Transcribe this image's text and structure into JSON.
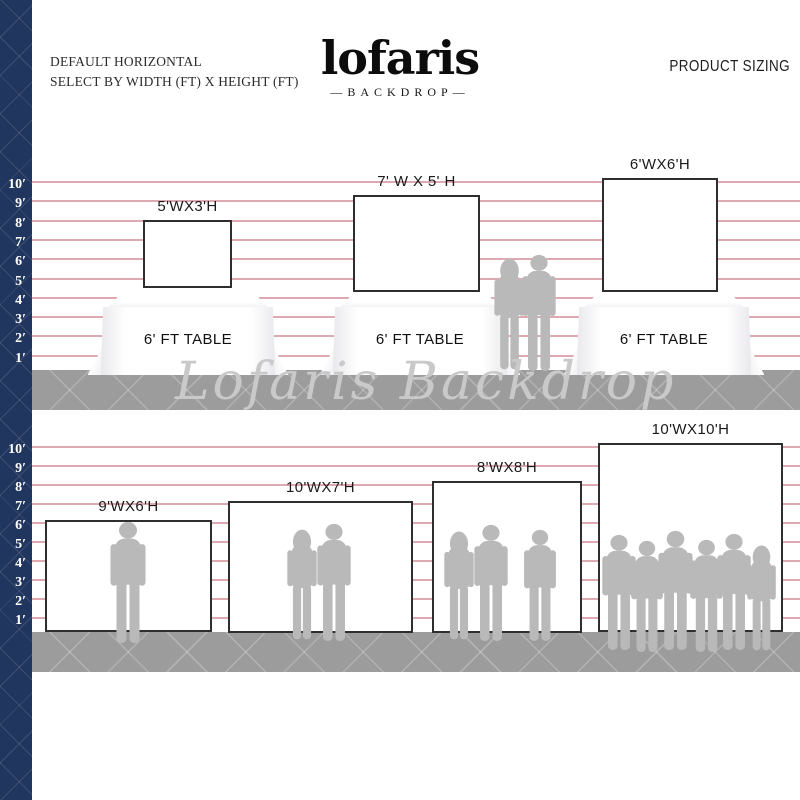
{
  "header": {
    "left_line1": "DEFAULT HORIZONTAL",
    "left_line2": "SELECT BY WIDTH (FT) X HEIGHT (FT)",
    "right_title": "PRODUCT SIZING"
  },
  "brand": {
    "name": "lofaris",
    "subtitle": "—BACKDROP—"
  },
  "watermark": "Lofaris Backdrop",
  "scale_marks": [
    "10′",
    "9′",
    "8′",
    "7′",
    "6′",
    "5′",
    "4′",
    "3′",
    "2′",
    "1′"
  ],
  "colors": {
    "navy": "#21365e",
    "grid_line": "#d6939c",
    "floor_gray": "#9c9c9c",
    "silhouette_gray": "#b9b9b9",
    "backdrop_border": "#2e2e2e"
  },
  "rows": [
    {
      "name": "tabletop-backdrops",
      "backdrops": [
        {
          "label": "5'WX3'H",
          "width_ft": 5,
          "height_ft": 3
        },
        {
          "label": "7' W X 5' H",
          "width_ft": 7,
          "height_ft": 5
        },
        {
          "label": "6'WX6'H",
          "width_ft": 6,
          "height_ft": 6
        }
      ],
      "tables": [
        "6' FT TABLE",
        "6' FT TABLE",
        "6' FT TABLE"
      ],
      "people_count": 2
    },
    {
      "name": "floor-backdrops",
      "backdrops": [
        {
          "label": "9'WX6'H",
          "width_ft": 9,
          "height_ft": 6
        },
        {
          "label": "10'WX7'H",
          "width_ft": 10,
          "height_ft": 7
        },
        {
          "label": "8'WX8'H",
          "width_ft": 8,
          "height_ft": 8
        },
        {
          "label": "10'WX10'H",
          "width_ft": 10,
          "height_ft": 10
        }
      ],
      "people_count": 12
    }
  ]
}
